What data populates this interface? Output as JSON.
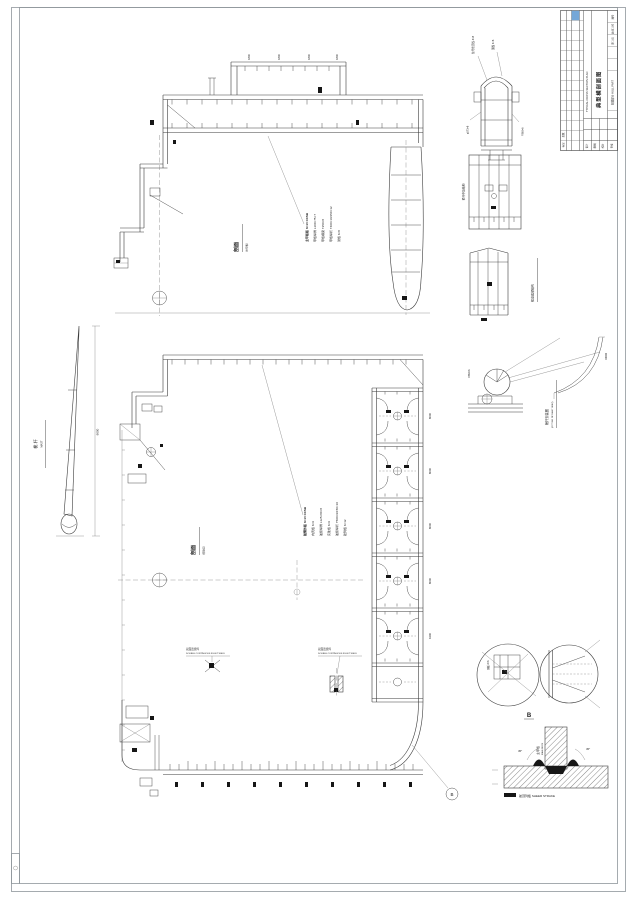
{
  "colors": {
    "line": "#3c3c3c",
    "frame_gray": "#8f969c",
    "accent_blue": "#74a7d8",
    "weld_black": "#161616"
  },
  "title_block": {
    "title_cn": "典型横剖面图",
    "title_en": "TYPICAL CROSS SECTION PLAN",
    "sub": "船体部分 HULL PART",
    "c1": "图号",
    "c2": "比例 1:50",
    "c3": "第 1 页",
    "b1": "设计",
    "b2": "制图",
    "b3": "校对",
    "b4": "审核",
    "strip1": "标记",
    "strip2": "处数"
  },
  "mast": {
    "cn": "桅 杆",
    "en": "MAST",
    "dim": "9000"
  },
  "views": {
    "v1": {
      "label": "剖面",
      "sub": "(主甲板)"
    },
    "v2": {
      "label": "剖面",
      "sub": "(货舱区)"
    }
  },
  "notes1": {
    "lines": [
      "主甲板板 δ=10 CCSB",
      "甲板纵骨 L100×75×7",
      "甲板横梁 T250×8",
      "甲板纵桁 T400×10/150×12",
      "肘板 δ=8"
    ]
  },
  "notes2": {
    "lines": [
      "舷侧外板 δ=10 CCSB",
      "内壳板 δ=9",
      "舷侧纵骨 L125×80×8",
      "实肋板 δ=9",
      "舷侧纵桁 T500×9/150×10",
      "舭列板 δ=12"
    ]
  },
  "details": {
    "d1": {
      "t1": "信号桅顶板 δ=8",
      "t2": "围板 δ=6",
      "left": "φ273×8",
      "right": "FB60×6"
    },
    "d2": {
      "label": "桅杆中段结构"
    },
    "d3": {
      "side": "桅座底部结构"
    },
    "d4": {
      "cn": "桅杆安装图",
      "en": "(FITTING OF MAST SEAT)",
      "radius": "R9000"
    }
  },
  "weld": {
    "deck_cn": "主甲板",
    "deck_en": "MAIN DECK",
    "sheer": "舷顶列板 SHEER STRAKE",
    "angle_l": "45°",
    "angle_r": "45°"
  },
  "weld_note": {
    "l1": "双面连续焊",
    "l2": "DOUBLE CONTINUOUS FILLET WELD"
  },
  "callout_b": "B",
  "dims": {
    "top": [
      "1800",
      "1800",
      "1800",
      "1800"
    ],
    "right": [
      "8000",
      "8000",
      "8000",
      "8000",
      "6300"
    ],
    "mast": "9000"
  }
}
